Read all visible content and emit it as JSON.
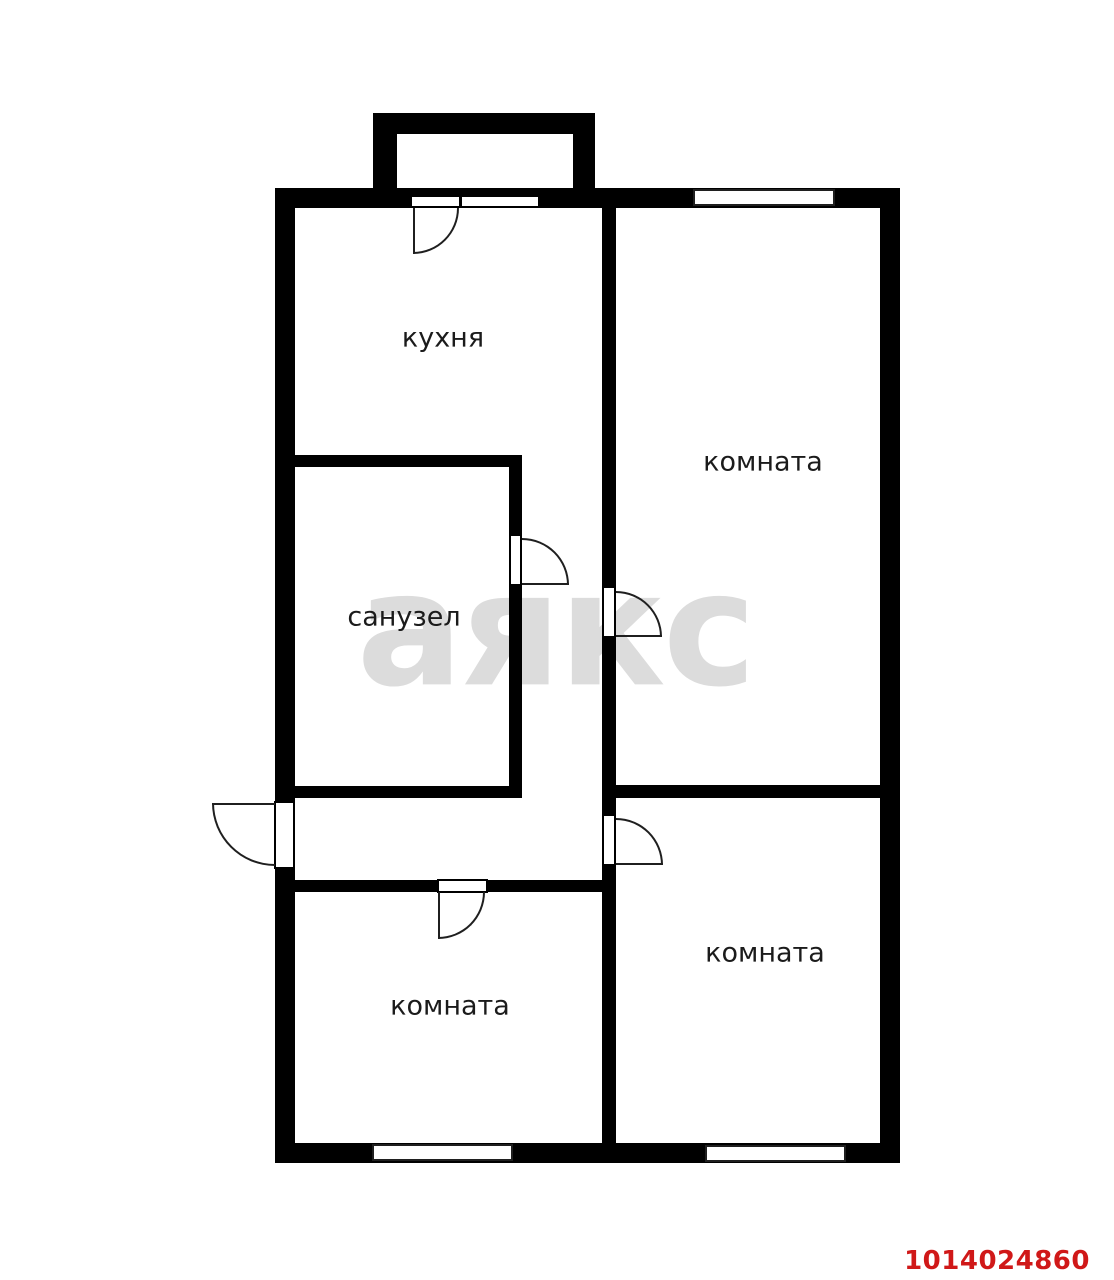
{
  "plan": {
    "watermark_text": "аякс",
    "listing_id": "1014024860"
  },
  "labels": {
    "kitchen": "кухня",
    "bathroom": "санузел",
    "room_top_right": "комната",
    "room_bottom_left": "комната",
    "room_bottom_right": "комната"
  },
  "colors": {
    "wall": "#000000",
    "label": "#1b1b1b",
    "line": "#1f1f1f",
    "watermark": "#dcdcdc",
    "id_red": "#d01818",
    "bg": "#ffffff"
  }
}
